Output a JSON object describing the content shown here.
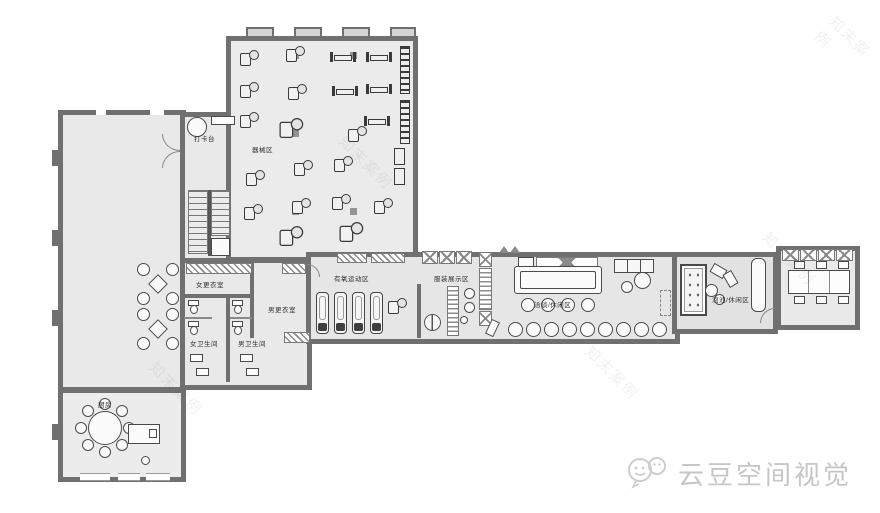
{
  "rooms": {
    "checkin": {
      "label": "打卡台"
    },
    "gym": {
      "label": "器械区"
    },
    "women_locker": {
      "label": "女更衣室"
    },
    "men_locker": {
      "label": "男更衣室"
    },
    "women_wc": {
      "label": "女卫生间"
    },
    "men_wc": {
      "label": "男卫生间"
    },
    "cardio": {
      "label": "有氧运动区"
    },
    "display": {
      "label": "服装展示区"
    },
    "lounge": {
      "label": "洽谈/休闲区"
    },
    "pool_lounge": {
      "label": "泡池/休闲区"
    },
    "kitchen": {
      "label": "厨房"
    }
  },
  "watermark": {
    "diagonal_text": "知末案例",
    "brand_text": "云豆空间视觉"
  },
  "colors": {
    "wall": "#707070",
    "floor": "#e9e9e9",
    "equipment_line": "#3a3a3a",
    "watermark_gray": "#c6c6c6"
  }
}
